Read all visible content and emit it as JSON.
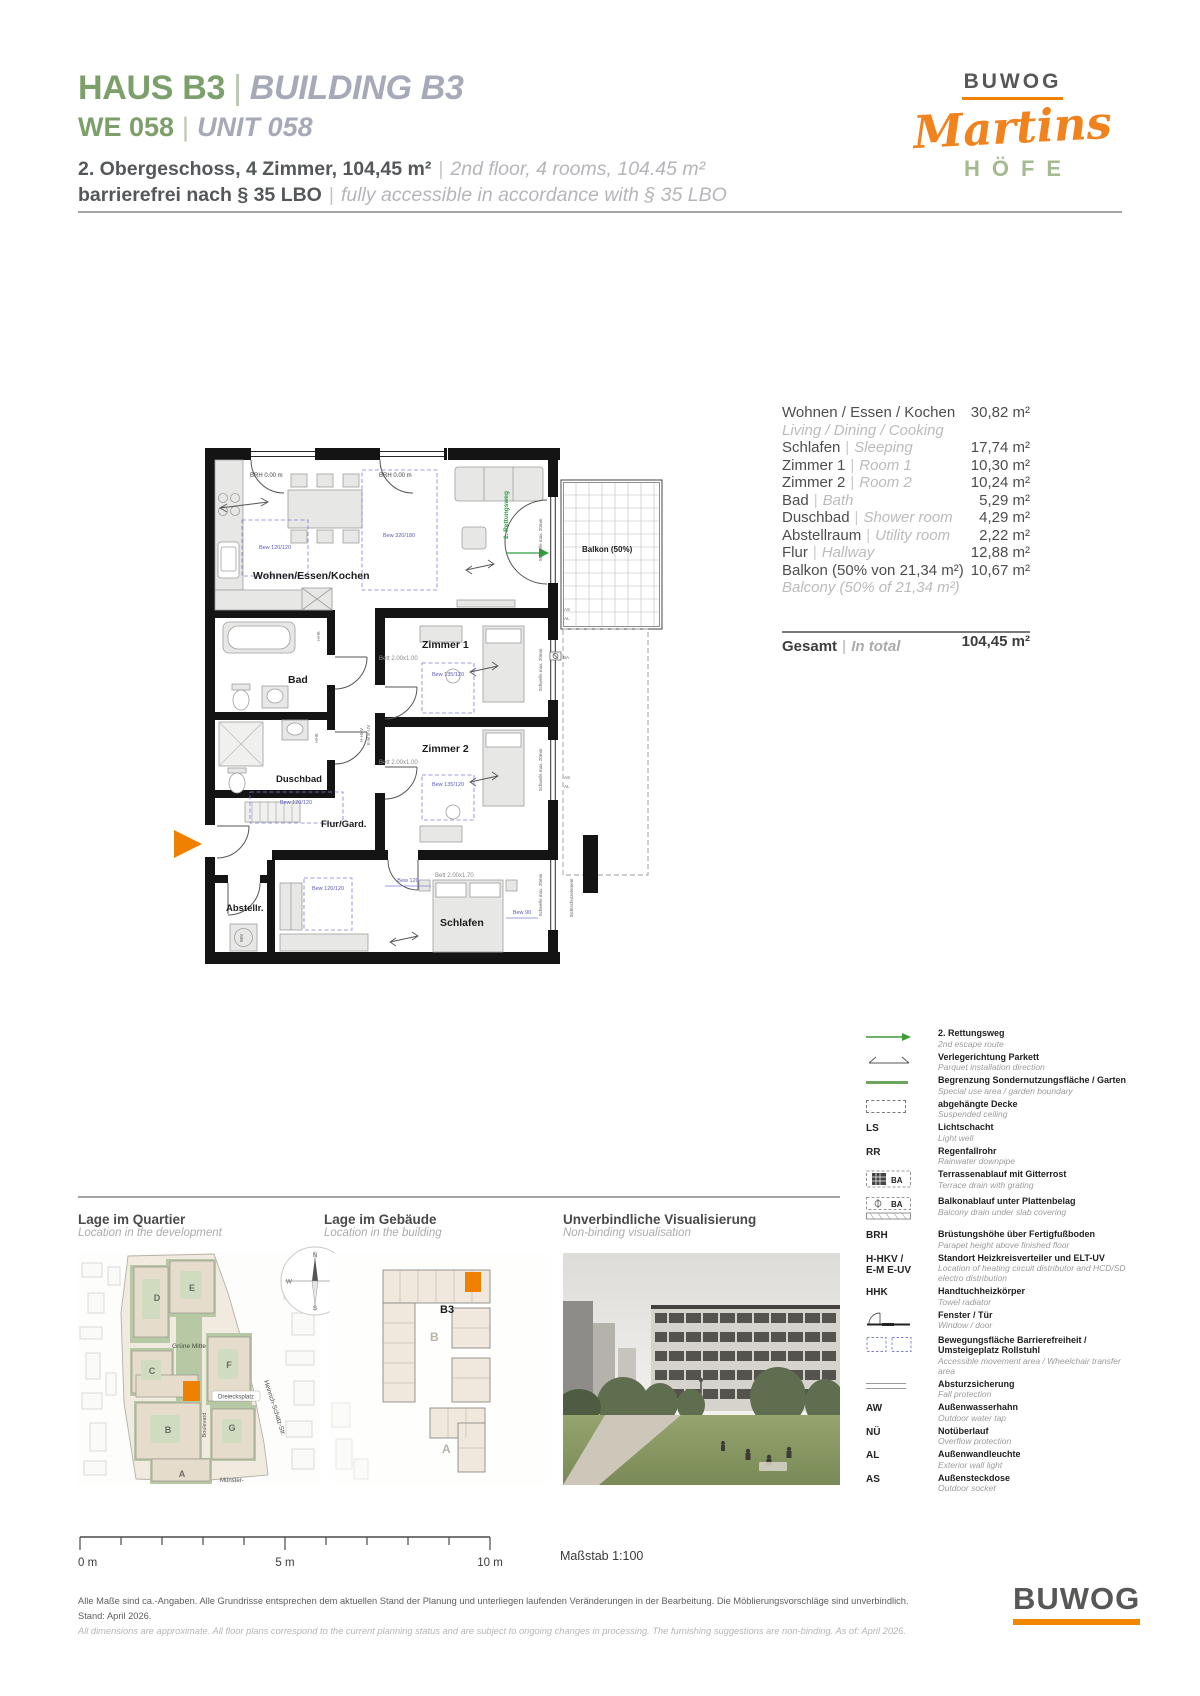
{
  "header": {
    "building_de": "HAUS B3",
    "building_en": "BUILDING B3",
    "unit_de": "WE 058",
    "unit_en": "UNIT 058",
    "info_de": "2. Obergeschoss, 4 Zimmer, 104,45 m²",
    "info_en": "2nd floor, 4 rooms, 104.45 m²",
    "access_de": "barrierefrei nach § 35 LBO",
    "access_en": "fully accessible in accordance with § 35 LBO"
  },
  "brand": {
    "logo": "BUWOG",
    "script": "Martins",
    "caps": "HÖFE"
  },
  "areas": {
    "rows": [
      {
        "de": "Wohnen / Essen / Kochen",
        "en": "Living / Dining / Cooking",
        "value": "30,82 m²"
      },
      {
        "de": "Schlafen",
        "en": "Sleeping",
        "value": "17,74 m²"
      },
      {
        "de": "Zimmer 1",
        "en": "Room 1",
        "value": "10,30 m²"
      },
      {
        "de": "Zimmer 2",
        "en": "Room 2",
        "value": "10,24 m²"
      },
      {
        "de": "Bad",
        "en": "Bath",
        "value": "5,29 m²"
      },
      {
        "de": "Duschbad",
        "en": "Shower room",
        "value": "4,29 m²"
      },
      {
        "de": "Abstellraum",
        "en": "Utility room",
        "value": "2,22 m²"
      },
      {
        "de": "Flur",
        "en": "Hallway",
        "value": "12,88 m²"
      },
      {
        "de": "Balkon (50% von 21,34 m²)",
        "en": "Balcony (50% of 21,34 m²)",
        "value": "10,67 m²"
      }
    ],
    "total": {
      "de": "Gesamt",
      "en": "In total",
      "value": "104,45 m²"
    }
  },
  "plan": {
    "rooms": {
      "living": "Wohnen/Essen/Kochen",
      "room1": "Zimmer 1",
      "room2": "Zimmer 2",
      "bath": "Bad",
      "shower": "Duschbad",
      "hall": "Flur/Gard.",
      "storage": "Abstellr.",
      "sleeping": "Schlafen",
      "balcony": "Balkon (50%)"
    },
    "ann": {
      "brh": "BRH 0.00 m",
      "escape": "2. Rettungsweg",
      "schwelle": "Schwelle max. 20mm",
      "bew_kitchen": "Bew 120/120",
      "bew_living": "Bew 320/180",
      "bew_room1": "Bew 135/120",
      "bew_room2": "Bew 135/120",
      "bew_hall": "Bew 120/120",
      "bew_sleeping": "Bew 120/120",
      "dim_120": "Bew 120",
      "dim_90": "Bew 90",
      "bett_room1": "Bett 2.00x1.00",
      "bett_room2": "Bett 2.00x1.00",
      "bett_sleeping": "Bett 2.00x1.70",
      "hkv1": "H-HKV",
      "hkv2": "E-M E-UV",
      "hhk": "HHK",
      "wm": "WM",
      "ba": "BA",
      "as": "AS",
      "al": "AL",
      "sicht": "Sichtschutzelement"
    }
  },
  "legend": {
    "items": [
      {
        "de": "2. Rettungsweg",
        "en": "2nd escape route"
      },
      {
        "de": "Verlegerichtung Parkett",
        "en": "Parquet installation direction"
      },
      {
        "de": "Begrenzung Sondernutzungsfläche / Garten",
        "en": "Special use area / garden boundary"
      },
      {
        "de": "abgehängte Decke",
        "en": "Suspended ceiling"
      },
      {
        "abbr": "LS",
        "de": "Lichtschacht",
        "en": "Light well"
      },
      {
        "abbr": "RR",
        "de": "Regenfallrohr",
        "en": "Rainwater downpipe"
      },
      {
        "abbr": "BA",
        "de": "Terrassenablauf mit Gitterrost",
        "en": "Terrace drain with grating"
      },
      {
        "abbr": "BA",
        "de": "Balkonablauf unter Plattenbelag",
        "en": "Balcony drain under slab covering"
      },
      {
        "abbr": "BRH",
        "de": "Brüstungshöhe über Fertigfußboden",
        "en": "Parapet height above finished floor"
      },
      {
        "abbr": "H-HKV /",
        "abbr2": "E-M  E-UV",
        "de": "Standort Heizkreisverteiler und ELT-UV",
        "en": "Location of heating circuit distributor and HCD/SD electro distribution"
      },
      {
        "abbr": "HHK",
        "de": "Handtuchheizkörper",
        "en": "Towel radiator"
      },
      {
        "de": "Fenster / Tür",
        "en": "Window / door"
      },
      {
        "de": "Bewegungsfläche Barrierefreiheit / Umsteigeplatz Rollstuhl",
        "en": "Accessible movement area / Wheelchair transfer area"
      },
      {
        "de": "Absturzsicherung",
        "en": "Fall protection"
      },
      {
        "abbr": "AW",
        "de": "Außenwasserhahn",
        "en": "Outdoor water tap"
      },
      {
        "abbr": "NÜ",
        "de": "Notüberlauf",
        "en": "Overflow protection"
      },
      {
        "abbr": "AL",
        "de": "Außenwandleuchte",
        "en": "Exterior wall light"
      },
      {
        "abbr": "AS",
        "de": "Außensteckdose",
        "en": "Outdoor socket"
      }
    ]
  },
  "maps": {
    "quartier": {
      "title": "Lage im Quartier",
      "subtitle": "Location in the development",
      "blocks": [
        "D",
        "E",
        "C",
        "F",
        "B",
        "G",
        "A"
      ],
      "green_center": "Grüne Mitte",
      "plaza": "Dreiecksplatz",
      "boulevard": "Boulevard",
      "street": "Heinrich-Schatz-Str.",
      "street2": "Münster-"
    },
    "building": {
      "title": "Lage im Gebäude",
      "subtitle": "Location in the building",
      "unit": "B3",
      "block_b": "B",
      "block_a": "A"
    },
    "visual": {
      "title": "Unverbindliche Visualisierung",
      "subtitle": "Non-binding visualisation"
    },
    "compass": {
      "n": "N",
      "o": "O",
      "s": "S",
      "w": "W"
    }
  },
  "scalebar": {
    "zero": "0 m",
    "five": "5 m",
    "ten": "10 m",
    "scale_label": "Maßstab 1:100"
  },
  "footer": {
    "disclaimer_de": "Alle Maße sind ca.-Angaben. Alle Grundrisse entsprechen dem aktuellen Stand der Planung und unterliegen laufenden Veränderungen in der Bearbeitung. Die Möblierungsvorschläge sind unverbindlich. Stand: April 2026.",
    "disclaimer_en": "All dimensions are approximate. All floor plans correspond to the current planning status and are subject to ongoing changes in processing. The furnishing suggestions are non-binding. As of: April 2026.",
    "logo": "BUWOG"
  },
  "colors": {
    "orange": "#F08100",
    "green": "#7DA06B",
    "caps_green": "#A4BA8F",
    "logo_gray": "#575756",
    "plan_green": "#2F9E41",
    "accessible_blue": "#7D7DD2"
  }
}
